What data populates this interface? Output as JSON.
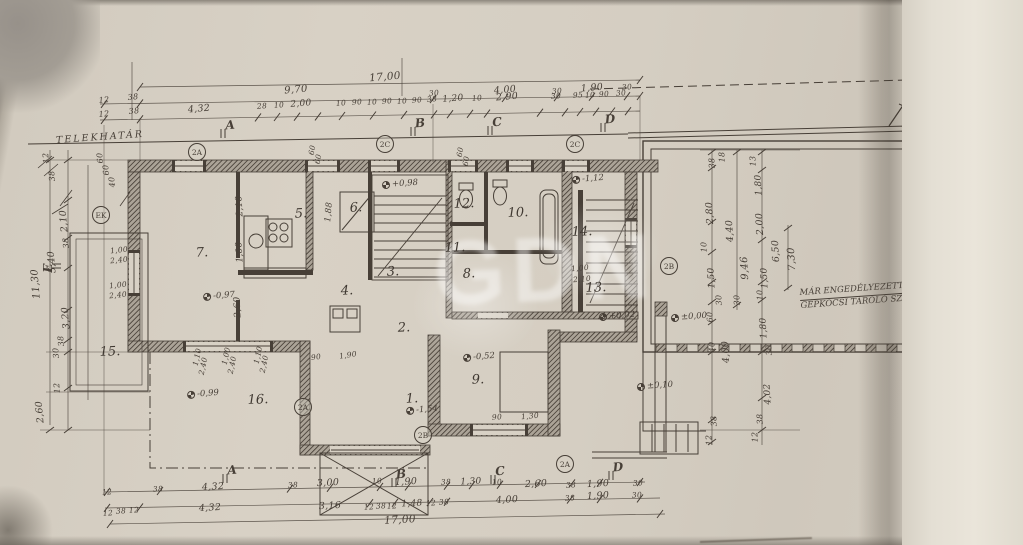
{
  "page": {
    "title_vertical": "FÖLDSZINTI ALAPRAJZ",
    "paper_color": "#d8d1c5",
    "ink_color": "#473f37"
  },
  "labels": {
    "property_line": "TELEKHATÁR",
    "garage_note_line1": "MÁR ENGEDÉLYEZETT",
    "garage_note_line2": "GÉPKOCSI TÁROLÓ SZÍN",
    "watermark": "GDN"
  },
  "annotations": {
    "rooms": [
      {
        "t": "1.",
        "x": 412,
        "y": 399
      },
      {
        "t": "2.",
        "x": 404,
        "y": 328
      },
      {
        "t": "3.",
        "x": 393,
        "y": 272
      },
      {
        "t": "4.",
        "x": 347,
        "y": 291
      },
      {
        "t": "5.",
        "x": 301,
        "y": 214
      },
      {
        "t": "6.",
        "x": 356,
        "y": 208
      },
      {
        "t": "7.",
        "x": 202,
        "y": 253
      },
      {
        "t": "8.",
        "x": 469,
        "y": 274
      },
      {
        "t": "9.",
        "x": 478,
        "y": 380
      },
      {
        "t": "10.",
        "x": 518,
        "y": 213
      },
      {
        "t": "11.",
        "x": 455,
        "y": 248
      },
      {
        "t": "12.",
        "x": 464,
        "y": 204
      },
      {
        "t": "13.",
        "x": 596,
        "y": 288
      },
      {
        "t": "14.",
        "x": 582,
        "y": 232
      },
      {
        "t": "15.",
        "x": 110,
        "y": 352
      },
      {
        "t": "16.",
        "x": 258,
        "y": 400
      }
    ],
    "dims_top": [
      {
        "t": "17,00",
        "x": 385,
        "y": 77,
        "s": 10.5
      },
      {
        "t": "12",
        "x": 104,
        "y": 100,
        "s": 8
      },
      {
        "t": "38",
        "x": 133,
        "y": 97,
        "s": 8
      },
      {
        "t": "9,70",
        "x": 296,
        "y": 90,
        "s": 10
      },
      {
        "t": "30",
        "x": 434,
        "y": 93
      },
      {
        "t": "4,00",
        "x": 505,
        "y": 90,
        "s": 9.5
      },
      {
        "t": "30",
        "x": 557,
        "y": 91
      },
      {
        "t": "1,90",
        "x": 592,
        "y": 88,
        "s": 9.5
      },
      {
        "t": "30",
        "x": 627,
        "y": 87
      },
      {
        "t": "12",
        "x": 104,
        "y": 114,
        "s": 8
      },
      {
        "t": "38",
        "x": 134,
        "y": 111,
        "s": 8
      },
      {
        "t": "4,32",
        "x": 199,
        "y": 109,
        "s": 9.5
      },
      {
        "t": "28",
        "x": 262,
        "y": 106
      },
      {
        "t": "10",
        "x": 279,
        "y": 105
      },
      {
        "t": "2,00",
        "x": 301,
        "y": 104,
        "s": 9
      },
      {
        "t": "10",
        "x": 341,
        "y": 103
      },
      {
        "t": "90",
        "x": 357,
        "y": 102
      },
      {
        "t": "10",
        "x": 372,
        "y": 102
      },
      {
        "t": "90",
        "x": 387,
        "y": 101
      },
      {
        "t": "10",
        "x": 402,
        "y": 101
      },
      {
        "t": "90",
        "x": 417,
        "y": 100
      },
      {
        "t": "38",
        "x": 432,
        "y": 99
      },
      {
        "t": "1,20",
        "x": 453,
        "y": 99,
        "s": 9
      },
      {
        "t": "10",
        "x": 477,
        "y": 98
      },
      {
        "t": "2,90",
        "x": 507,
        "y": 97,
        "s": 9.5
      },
      {
        "t": "30",
        "x": 556,
        "y": 96
      },
      {
        "t": "95",
        "x": 578,
        "y": 95
      },
      {
        "t": "10",
        "x": 590,
        "y": 95
      },
      {
        "t": "90",
        "x": 604,
        "y": 94
      },
      {
        "t": "30",
        "x": 621,
        "y": 93
      }
    ],
    "dims_bottom": [
      {
        "t": "17,00",
        "x": 400,
        "y": 520,
        "s": 10.5
      },
      {
        "t": "12",
        "x": 107,
        "y": 492
      },
      {
        "t": "38",
        "x": 158,
        "y": 489
      },
      {
        "t": "4,32",
        "x": 213,
        "y": 487,
        "s": 9.5
      },
      {
        "t": "38",
        "x": 293,
        "y": 485
      },
      {
        "t": "3,00",
        "x": 328,
        "y": 483,
        "s": 9.5
      },
      {
        "t": "10",
        "x": 377,
        "y": 481
      },
      {
        "t": "1,90",
        "x": 406,
        "y": 482,
        "s": 9.5
      },
      {
        "t": "38",
        "x": 446,
        "y": 482
      },
      {
        "t": "1,30",
        "x": 471,
        "y": 482,
        "s": 9
      },
      {
        "t": "10",
        "x": 497,
        "y": 482
      },
      {
        "t": "2,60",
        "x": 536,
        "y": 484,
        "s": 9.5
      },
      {
        "t": "38",
        "x": 571,
        "y": 485
      },
      {
        "t": "1,90",
        "x": 598,
        "y": 484,
        "s": 9.5
      },
      {
        "t": "30",
        "x": 638,
        "y": 483
      },
      {
        "t": "12",
        "x": 108,
        "y": 513
      },
      {
        "t": "38",
        "x": 121,
        "y": 511
      },
      {
        "t": "12",
        "x": 134,
        "y": 510
      },
      {
        "t": "4,32",
        "x": 210,
        "y": 508,
        "s": 9.5
      },
      {
        "t": "3,16",
        "x": 330,
        "y": 506,
        "s": 9.5
      },
      {
        "t": "12",
        "x": 369,
        "y": 507
      },
      {
        "t": "38",
        "x": 381,
        "y": 506
      },
      {
        "t": "12",
        "x": 392,
        "y": 506
      },
      {
        "t": "1,48",
        "x": 412,
        "y": 504,
        "s": 9
      },
      {
        "t": "12",
        "x": 431,
        "y": 503
      },
      {
        "t": "38",
        "x": 444,
        "y": 502
      },
      {
        "t": "4,00",
        "x": 507,
        "y": 500,
        "s": 9.5
      },
      {
        "t": "38",
        "x": 570,
        "y": 498
      },
      {
        "t": "1,90",
        "x": 598,
        "y": 496,
        "s": 9.5
      },
      {
        "t": "30",
        "x": 637,
        "y": 495
      }
    ],
    "dims_left": [
      {
        "t": "12",
        "x": 46,
        "y": 158
      },
      {
        "t": "38",
        "x": 52,
        "y": 176
      },
      {
        "t": "2,10",
        "x": 64,
        "y": 221,
        "s": 9.5
      },
      {
        "t": "5,40",
        "x": 52,
        "y": 262,
        "s": 9.5
      },
      {
        "t": "38",
        "x": 66,
        "y": 243
      },
      {
        "t": "11,30",
        "x": 36,
        "y": 284,
        "s": 10
      },
      {
        "t": "3,20",
        "x": 66,
        "y": 318,
        "s": 9.5
      },
      {
        "t": "38",
        "x": 61,
        "y": 341
      },
      {
        "t": "30",
        "x": 56,
        "y": 353
      },
      {
        "t": "12",
        "x": 57,
        "y": 388
      },
      {
        "t": "2,60",
        "x": 40,
        "y": 412,
        "s": 9.5
      },
      {
        "t": "60",
        "x": 100,
        "y": 158
      },
      {
        "t": "60",
        "x": 106,
        "y": 170
      },
      {
        "t": "40",
        "x": 112,
        "y": 182
      }
    ],
    "dims_right": [
      {
        "t": "38",
        "x": 712,
        "y": 163
      },
      {
        "t": "2,80",
        "x": 710,
        "y": 213,
        "s": 9.5
      },
      {
        "t": "10",
        "x": 704,
        "y": 247
      },
      {
        "t": "1,50",
        "x": 712,
        "y": 278,
        "s": 9
      },
      {
        "t": "30",
        "x": 719,
        "y": 300
      },
      {
        "t": "60",
        "x": 710,
        "y": 317
      },
      {
        "t": "40",
        "x": 712,
        "y": 347
      },
      {
        "t": "4,00",
        "x": 726,
        "y": 352,
        "s": 9.5
      },
      {
        "t": "38",
        "x": 714,
        "y": 421
      },
      {
        "t": "12",
        "x": 709,
        "y": 440
      },
      {
        "t": "18",
        "x": 722,
        "y": 157
      },
      {
        "t": "4,40",
        "x": 730,
        "y": 231,
        "s": 9.5
      },
      {
        "t": "30",
        "x": 737,
        "y": 300
      },
      {
        "t": "9,46",
        "x": 745,
        "y": 268,
        "s": 10
      },
      {
        "t": "13",
        "x": 753,
        "y": 161
      },
      {
        "t": "1,80",
        "x": 759,
        "y": 185,
        "s": 9
      },
      {
        "t": "2,00",
        "x": 760,
        "y": 224,
        "s": 9.5
      },
      {
        "t": "1,50",
        "x": 765,
        "y": 278,
        "s": 9
      },
      {
        "t": "10",
        "x": 760,
        "y": 295
      },
      {
        "t": "1,80",
        "x": 764,
        "y": 328,
        "s": 9
      },
      {
        "t": "30",
        "x": 769,
        "y": 350
      },
      {
        "t": "4,02",
        "x": 768,
        "y": 394,
        "s": 9
      },
      {
        "t": "38",
        "x": 760,
        "y": 419
      },
      {
        "t": "12",
        "x": 755,
        "y": 437
      },
      {
        "t": "6,50",
        "x": 776,
        "y": 251,
        "s": 9.5
      },
      {
        "t": "7,30",
        "x": 792,
        "y": 259,
        "s": 10
      }
    ],
    "dims_inner": [
      {
        "t": "2,10",
        "x": 240,
        "y": 206,
        "r": -93,
        "s": 9
      },
      {
        "t": "1,00",
        "x": 240,
        "y": 252,
        "r": -93,
        "s": 9
      },
      {
        "t": "2,60",
        "x": 238,
        "y": 307,
        "r": -93,
        "s": 9
      },
      {
        "t": "1,00",
        "x": 119,
        "y": 250,
        "r": -6
      },
      {
        "t": "2,40",
        "x": 119,
        "y": 260,
        "r": -6
      },
      {
        "t": "1,00",
        "x": 118,
        "y": 285,
        "r": -6
      },
      {
        "t": "2,40",
        "x": 118,
        "y": 295,
        "r": -6
      },
      {
        "t": "1,10",
        "x": 197,
        "y": 357,
        "r": -78
      },
      {
        "t": "2,40",
        "x": 203,
        "y": 366,
        "r": -78
      },
      {
        "t": "1,00",
        "x": 226,
        "y": 356,
        "r": -78
      },
      {
        "t": "2,40",
        "x": 232,
        "y": 365,
        "r": -78
      },
      {
        "t": "1,10",
        "x": 258,
        "y": 355,
        "r": -78
      },
      {
        "t": "2,40",
        "x": 264,
        "y": 364,
        "r": -78
      },
      {
        "t": "90",
        "x": 316,
        "y": 357,
        "r": -8
      },
      {
        "t": "1,90",
        "x": 348,
        "y": 355,
        "r": -8
      },
      {
        "t": "90",
        "x": 497,
        "y": 417
      },
      {
        "t": "1,30",
        "x": 530,
        "y": 416
      },
      {
        "t": "1,00",
        "x": 580,
        "y": 268
      },
      {
        "t": "2,10",
        "x": 582,
        "y": 279
      },
      {
        "t": "60",
        "x": 312,
        "y": 150,
        "r": -80
      },
      {
        "t": "60",
        "x": 318,
        "y": 159,
        "r": -80
      },
      {
        "t": "60",
        "x": 460,
        "y": 152,
        "r": -80
      },
      {
        "t": "60",
        "x": 466,
        "y": 161,
        "r": -80
      },
      {
        "t": "1,88",
        "x": 329,
        "y": 212,
        "r": -85,
        "s": 8.5
      }
    ],
    "levels": [
      {
        "t": "-0,97",
        "x": 219,
        "y": 296
      },
      {
        "t": "-0,99",
        "x": 203,
        "y": 394
      },
      {
        "t": "-0,52",
        "x": 479,
        "y": 357
      },
      {
        "t": "-1,54",
        "x": 422,
        "y": 410
      },
      {
        "t": "+0,98",
        "x": 400,
        "y": 184
      },
      {
        "t": "-1,12",
        "x": 588,
        "y": 179
      },
      {
        "t": "+0,02",
        "x": 617,
        "y": 316
      },
      {
        "t": "±0,00",
        "x": 689,
        "y": 317
      },
      {
        "t": "±0,10",
        "x": 655,
        "y": 386
      }
    ],
    "sections": [
      {
        "t": "A",
        "x": 230,
        "y": 125
      },
      {
        "t": "B",
        "x": 420,
        "y": 123
      },
      {
        "t": "C",
        "x": 497,
        "y": 122
      },
      {
        "t": "D",
        "x": 610,
        "y": 119
      },
      {
        "t": "A",
        "x": 232,
        "y": 470
      },
      {
        "t": "B",
        "x": 401,
        "y": 474
      },
      {
        "t": "C",
        "x": 500,
        "y": 471
      },
      {
        "t": "D",
        "x": 618,
        "y": 467
      },
      {
        "t": "E",
        "x": 48,
        "y": 268,
        "r": -90
      },
      {
        "t": "E",
        "x": 952,
        "y": 252,
        "r": -90
      }
    ],
    "circles": [
      {
        "t": "EK",
        "x": 101,
        "y": 215
      },
      {
        "t": "2A",
        "x": 197,
        "y": 152
      },
      {
        "t": "2C",
        "x": 385,
        "y": 144
      },
      {
        "t": "2C",
        "x": 575,
        "y": 144
      },
      {
        "t": "2B",
        "x": 669,
        "y": 266
      },
      {
        "t": "2A",
        "x": 303,
        "y": 407
      },
      {
        "t": "2B",
        "x": 423,
        "y": 435
      },
      {
        "t": "2A",
        "x": 565,
        "y": 464
      }
    ]
  }
}
